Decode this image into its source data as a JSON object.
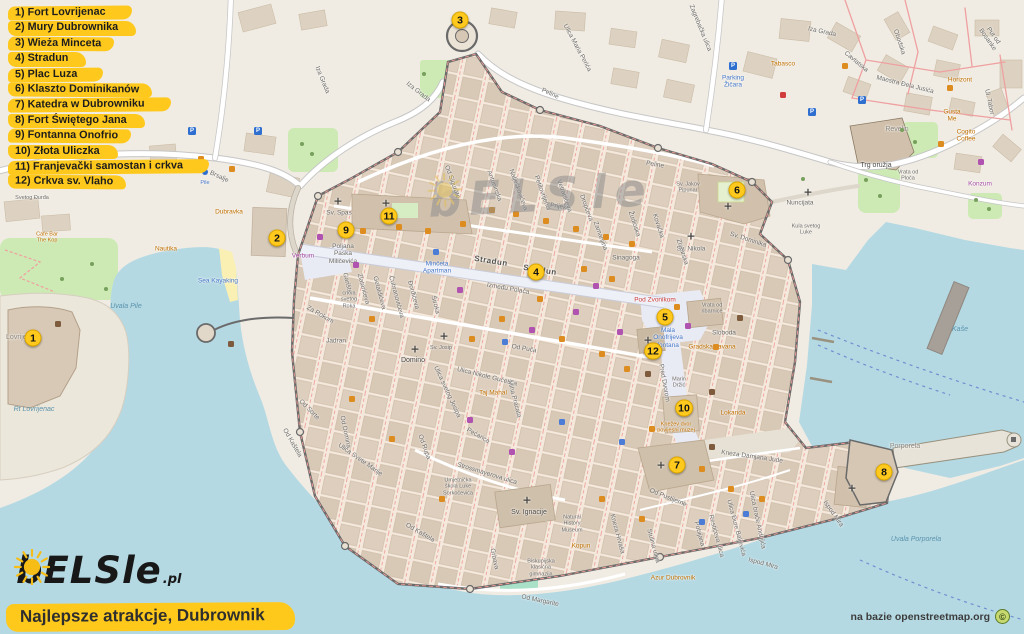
{
  "legend": {
    "items": [
      "1) Fort Lovrijenac",
      "2) Mury Dubrownika",
      "3) Wieża Minceta",
      "4) Stradun",
      "5) Plac Luza",
      "6) Klaszto Dominikanów",
      "7) Katedra w Dubrowniku",
      "8) Fort Świętego Jana",
      "9) Fontanna Onofrio",
      "10) Złota Uliczka",
      "11) Franjevački samostan i crkva",
      "12) Crkva sv. Vlaho"
    ]
  },
  "watermark": {
    "left": "bELS",
    "right": "le",
    "sun_icon": "sun-icon"
  },
  "logo": {
    "left": "bELS",
    "right": "le",
    "tld": ".pl",
    "sun_icon": "sun-icon"
  },
  "title": {
    "text": "Najlepsze atrakcje, Dubrownik"
  },
  "attribution": {
    "text": "na bazie openstreetmap.org",
    "symbol": "©"
  },
  "colors": {
    "legend_yellow": "#ffc81c",
    "marker_yellow": "#ffc91d",
    "water": "#b5d9e3",
    "land": "#f0ece3",
    "building": "#ddcebd",
    "wall": "#6a6a6a",
    "park": "#cdeab4"
  },
  "map": {
    "markers": [
      {
        "n": "1",
        "x": 33,
        "y": 338
      },
      {
        "n": "2",
        "x": 277,
        "y": 238
      },
      {
        "n": "3",
        "x": 460,
        "y": 20
      },
      {
        "n": "4",
        "x": 536,
        "y": 272
      },
      {
        "n": "5",
        "x": 665,
        "y": 317
      },
      {
        "n": "6",
        "x": 737,
        "y": 190
      },
      {
        "n": "7",
        "x": 677,
        "y": 465
      },
      {
        "n": "8",
        "x": 884,
        "y": 472
      },
      {
        "n": "9",
        "x": 346,
        "y": 230
      },
      {
        "n": "10",
        "x": 684,
        "y": 408
      },
      {
        "n": "11",
        "x": 389,
        "y": 216
      },
      {
        "n": "12",
        "x": 653,
        "y": 351
      }
    ],
    "labels": [
      {
        "t": "Zagrebačka ulica",
        "x": 700,
        "y": 28,
        "r": 68
      },
      {
        "t": "Iza Grada",
        "x": 822,
        "y": 32,
        "r": 12
      },
      {
        "t": "Iza Grada",
        "x": 418,
        "y": 92,
        "r": 38
      },
      {
        "t": "Iza Grada",
        "x": 322,
        "y": 80,
        "r": 68
      },
      {
        "t": "Ulica Maria Perića",
        "x": 577,
        "y": 48,
        "r": 62
      },
      {
        "t": "Parking\nŽičara",
        "x": 733,
        "y": 82,
        "c": "blu"
      },
      {
        "t": "Cavtatska",
        "x": 856,
        "y": 62,
        "r": 40
      },
      {
        "t": "Obodska",
        "x": 899,
        "y": 42,
        "r": 72
      },
      {
        "t": "Maestra Đela Jusića",
        "x": 905,
        "y": 85,
        "r": 14
      },
      {
        "t": "Put od Bosanke",
        "x": 990,
        "y": 38,
        "r": 55
      },
      {
        "t": "Ul. Tabor",
        "x": 989,
        "y": 102,
        "r": 78
      },
      {
        "t": "Horizont",
        "x": 960,
        "y": 80,
        "c": "poi"
      },
      {
        "t": "Gusta\nMe",
        "x": 952,
        "y": 116,
        "c": "poi"
      },
      {
        "t": "Cogito\nCoffee",
        "x": 966,
        "y": 136,
        "c": "poi"
      },
      {
        "t": "Tabasco",
        "x": 783,
        "y": 64,
        "c": "poi"
      },
      {
        "t": "Revelin",
        "x": 897,
        "y": 130,
        "c": "area"
      },
      {
        "t": "Trg oružja",
        "x": 876,
        "y": 166,
        "c": "dark"
      },
      {
        "t": "Vrata od\nPloča",
        "x": 908,
        "y": 176,
        "c": "sm"
      },
      {
        "t": "Kula svetog\nLuke",
        "x": 806,
        "y": 230,
        "c": "sm"
      },
      {
        "t": "Nuncijata",
        "x": 800,
        "y": 203
      },
      {
        "t": "Konzum",
        "x": 980,
        "y": 184,
        "c": "shop"
      },
      {
        "t": "Peline",
        "x": 550,
        "y": 94,
        "r": 25
      },
      {
        "t": "Peline",
        "x": 655,
        "y": 165,
        "r": 10
      },
      {
        "t": "Prijeko",
        "x": 560,
        "y": 207,
        "r": 9
      },
      {
        "t": "Stradun",
        "x": 491,
        "y": 261,
        "r": 9,
        "c": "lg"
      },
      {
        "t": "Stradun",
        "x": 540,
        "y": 270,
        "r": 9,
        "c": "lg"
      },
      {
        "t": "Između Polača",
        "x": 508,
        "y": 289,
        "r": 10
      },
      {
        "t": "Od Puča",
        "x": 524,
        "y": 349,
        "r": 10
      },
      {
        "t": "Od Sigurate",
        "x": 452,
        "y": 182,
        "r": 70
      },
      {
        "t": "Antuninska",
        "x": 494,
        "y": 186,
        "r": 70
      },
      {
        "t": "Nalješkovićeva",
        "x": 518,
        "y": 190,
        "r": 70
      },
      {
        "t": "Petilovrijenci",
        "x": 542,
        "y": 193,
        "r": 70
      },
      {
        "t": "Vetranićeva",
        "x": 564,
        "y": 196,
        "r": 70
      },
      {
        "t": "Dropčeva",
        "x": 586,
        "y": 208,
        "r": 70
      },
      {
        "t": "Zamanjina",
        "x": 600,
        "y": 236,
        "r": 70
      },
      {
        "t": "Žudioska",
        "x": 634,
        "y": 224,
        "r": 72
      },
      {
        "t": "Kovačka",
        "x": 658,
        "y": 226,
        "r": 72
      },
      {
        "t": "Zlatarska",
        "x": 682,
        "y": 252,
        "r": 72
      },
      {
        "t": "Sv. Jakov\nPipunar",
        "x": 688,
        "y": 188,
        "c": "sm"
      },
      {
        "t": "Sv. Nikola",
        "x": 691,
        "y": 249
      },
      {
        "t": "Sinagoga",
        "x": 626,
        "y": 258
      },
      {
        "t": "Sv. Dominika",
        "x": 748,
        "y": 240,
        "r": 18
      },
      {
        "t": "Sv. Spas",
        "x": 339,
        "y": 213
      },
      {
        "t": "Poljana\nPaska\nMiličevića",
        "x": 343,
        "y": 254
      },
      {
        "t": "Verbum",
        "x": 303,
        "y": 256,
        "c": "shop"
      },
      {
        "t": "Minčeta\nApartman",
        "x": 437,
        "y": 268,
        "c": "blu"
      },
      {
        "t": "Garište",
        "x": 347,
        "y": 283,
        "r": 75
      },
      {
        "t": "Zlatarićeva",
        "x": 363,
        "y": 289,
        "r": 75
      },
      {
        "t": "Getaldićeva",
        "x": 379,
        "y": 293,
        "r": 75
      },
      {
        "t": "Čubranovićeva",
        "x": 396,
        "y": 297,
        "r": 75
      },
      {
        "t": "Đorđićeva",
        "x": 413,
        "y": 295,
        "r": 75
      },
      {
        "t": "Široka",
        "x": 435,
        "y": 305,
        "r": 75
      },
      {
        "t": "crkva\nsvetog\nRoka",
        "x": 349,
        "y": 300,
        "c": "sm"
      },
      {
        "t": "Za Rokom",
        "x": 320,
        "y": 315,
        "r": 30
      },
      {
        "t": "Jadran",
        "x": 336,
        "y": 341
      },
      {
        "t": "Domino",
        "x": 413,
        "y": 361,
        "c": "dark"
      },
      {
        "t": "Sv. Josip",
        "x": 441,
        "y": 348,
        "c": "sm"
      },
      {
        "t": "Ulica svetog Josipa",
        "x": 447,
        "y": 392,
        "r": 65
      },
      {
        "t": "Od Domina",
        "x": 345,
        "y": 432,
        "r": 78
      },
      {
        "t": "Od Sorte",
        "x": 309,
        "y": 410,
        "r": 45
      },
      {
        "t": "Od Kaštela",
        "x": 292,
        "y": 443,
        "r": 60
      },
      {
        "t": "Od Kaštela",
        "x": 420,
        "y": 533,
        "r": 30
      },
      {
        "t": "Od Rupa",
        "x": 424,
        "y": 447,
        "r": 70
      },
      {
        "t": "Ulica Svete Marije",
        "x": 360,
        "y": 460,
        "r": 35
      },
      {
        "t": "Ulica Nikole Gučetića",
        "x": 487,
        "y": 377,
        "r": 14
      },
      {
        "t": "Miha Pracata",
        "x": 514,
        "y": 399,
        "r": 75
      },
      {
        "t": "Pećarica",
        "x": 478,
        "y": 436,
        "r": 30
      },
      {
        "t": "Taj Mahal",
        "x": 493,
        "y": 393,
        "c": "poi"
      },
      {
        "t": "Strossmayerova ulica",
        "x": 487,
        "y": 474,
        "r": 17
      },
      {
        "t": "Umjetnička\nškola Luke\nSorkočevića",
        "x": 458,
        "y": 487,
        "c": "sm"
      },
      {
        "t": "Sv. Ignacije",
        "x": 529,
        "y": 513,
        "c": "dark"
      },
      {
        "t": "Grbava",
        "x": 494,
        "y": 559,
        "r": 78
      },
      {
        "t": "Biskupijska\nklasična\ngimnazija",
        "x": 541,
        "y": 568,
        "c": "sm"
      },
      {
        "t": "Od Margarite",
        "x": 540,
        "y": 601,
        "r": 12
      },
      {
        "t": "Natural\nHistory\nMuseum",
        "x": 572,
        "y": 524,
        "c": "sm"
      },
      {
        "t": "Kopun",
        "x": 581,
        "y": 546,
        "c": "poi"
      },
      {
        "t": "Kneza Hrvaša",
        "x": 617,
        "y": 534,
        "r": 75
      },
      {
        "t": "Od Pustijerne",
        "x": 668,
        "y": 498,
        "r": 22
      },
      {
        "t": "Stulina ulica",
        "x": 653,
        "y": 546,
        "r": 75
      },
      {
        "t": "Pobijana",
        "x": 699,
        "y": 534,
        "r": 75
      },
      {
        "t": "Restićeva ulica",
        "x": 716,
        "y": 536,
        "r": 75
      },
      {
        "t": "Ulica Đure Baljevića",
        "x": 736,
        "y": 528,
        "r": 75
      },
      {
        "t": "Ulica braće Andrijića",
        "x": 757,
        "y": 520,
        "r": 78
      },
      {
        "t": "Ispod Mira",
        "x": 763,
        "y": 564,
        "r": 15
      },
      {
        "t": "Ispod Mira",
        "x": 833,
        "y": 514,
        "r": 55
      },
      {
        "t": "Azur Dubrovnik",
        "x": 673,
        "y": 578,
        "c": "poi"
      },
      {
        "t": "Kneza Damjana Jude",
        "x": 752,
        "y": 457,
        "r": 8
      },
      {
        "t": "Pred Dvorom",
        "x": 664,
        "y": 383,
        "r": 80
      },
      {
        "t": "Pod Zvonikom",
        "x": 655,
        "y": 300,
        "c": "red"
      },
      {
        "t": "Mala\nOnofrijeva\nfontana",
        "x": 668,
        "y": 338,
        "c": "blu"
      },
      {
        "t": "Vrata od\nribarnice",
        "x": 712,
        "y": 309,
        "c": "sm"
      },
      {
        "t": "Sloboda",
        "x": 724,
        "y": 333
      },
      {
        "t": "Gradska kavana",
        "x": 712,
        "y": 347,
        "c": "poi"
      },
      {
        "t": "Marin\nDržić",
        "x": 679,
        "y": 383,
        "c": "sm"
      },
      {
        "t": "Lokanda",
        "x": 733,
        "y": 413,
        "c": "poi"
      },
      {
        "t": "Knežev dvor\npovijesni muzej",
        "x": 676,
        "y": 428,
        "c": "poi sm"
      },
      {
        "t": "Porporela",
        "x": 905,
        "y": 447,
        "c": "area"
      },
      {
        "t": "Uvala Porporela",
        "x": 916,
        "y": 540,
        "c": "wtr"
      },
      {
        "t": "Kaše",
        "x": 960,
        "y": 330,
        "c": "wtr sm"
      },
      {
        "t": "Rt Lovrijenac",
        "x": 34,
        "y": 410,
        "c": "wtr sm"
      },
      {
        "t": "Lovrijenac",
        "x": 22,
        "y": 338,
        "c": "area"
      },
      {
        "t": "Uvala Pile",
        "x": 126,
        "y": 307,
        "c": "wtr"
      },
      {
        "t": "Sea Kayaking",
        "x": 218,
        "y": 281,
        "c": "blu"
      },
      {
        "t": "Nautika",
        "x": 166,
        "y": 249,
        "c": "poi"
      },
      {
        "t": "Dubravka",
        "x": 229,
        "y": 212,
        "c": "poi"
      },
      {
        "t": "Brsalje",
        "x": 219,
        "y": 177,
        "r": 25
      },
      {
        "t": "Pile",
        "x": 205,
        "y": 183,
        "c": "blu sm"
      },
      {
        "t": "Cafe Bar\nThe Kop",
        "x": 47,
        "y": 238,
        "c": "poi sm"
      },
      {
        "t": "Svetog Đurđa",
        "x": 32,
        "y": 198,
        "c": "sm"
      }
    ],
    "pois": [
      {
        "x": 338,
        "y": 201,
        "c": "x"
      },
      {
        "x": 386,
        "y": 203,
        "c": "x"
      },
      {
        "x": 415,
        "y": 349,
        "c": "x"
      },
      {
        "x": 444,
        "y": 336,
        "c": "x"
      },
      {
        "x": 527,
        "y": 500,
        "c": "x"
      },
      {
        "x": 691,
        "y": 236,
        "c": "x"
      },
      {
        "x": 728,
        "y": 206,
        "c": "x"
      },
      {
        "x": 661,
        "y": 465,
        "c": "x"
      },
      {
        "x": 852,
        "y": 488,
        "c": "x"
      },
      {
        "x": 648,
        "y": 340,
        "c": "x"
      },
      {
        "x": 808,
        "y": 192,
        "c": "x"
      },
      {
        "x": 733,
        "y": 66,
        "c": "p"
      },
      {
        "x": 812,
        "y": 112,
        "c": "p"
      },
      {
        "x": 862,
        "y": 100,
        "c": "p"
      },
      {
        "x": 192,
        "y": 131,
        "c": "p"
      },
      {
        "x": 258,
        "y": 131,
        "c": "p"
      },
      {
        "x": 205,
        "y": 172,
        "c": "b"
      },
      {
        "x": 783,
        "y": 95,
        "c": "a"
      },
      {
        "x": 436,
        "y": 252,
        "c": "h"
      },
      {
        "x": 505,
        "y": 342,
        "c": "h"
      },
      {
        "x": 562,
        "y": 422,
        "c": "h"
      },
      {
        "x": 622,
        "y": 442,
        "c": "h"
      },
      {
        "x": 702,
        "y": 522,
        "c": "h"
      },
      {
        "x": 746,
        "y": 514,
        "c": "h"
      },
      {
        "x": 320,
        "y": 237,
        "c": "s"
      },
      {
        "x": 356,
        "y": 265,
        "c": "s"
      },
      {
        "x": 460,
        "y": 290,
        "c": "s"
      },
      {
        "x": 532,
        "y": 330,
        "c": "s"
      },
      {
        "x": 576,
        "y": 312,
        "c": "s"
      },
      {
        "x": 620,
        "y": 332,
        "c": "s"
      },
      {
        "x": 688,
        "y": 326,
        "c": "s"
      },
      {
        "x": 470,
        "y": 420,
        "c": "s"
      },
      {
        "x": 512,
        "y": 452,
        "c": "s"
      },
      {
        "x": 981,
        "y": 162,
        "c": "s"
      },
      {
        "x": 596,
        "y": 286,
        "c": "s"
      },
      {
        "x": 58,
        "y": 324,
        "c": "m"
      },
      {
        "x": 740,
        "y": 318,
        "c": "m"
      },
      {
        "x": 712,
        "y": 392,
        "c": "m"
      },
      {
        "x": 231,
        "y": 344,
        "c": "m"
      },
      {
        "x": 648,
        "y": 374,
        "c": "m"
      },
      {
        "x": 712,
        "y": 447,
        "c": "m"
      },
      {
        "x": 363,
        "y": 231,
        "c": "f"
      },
      {
        "x": 399,
        "y": 227,
        "c": "f"
      },
      {
        "x": 428,
        "y": 231,
        "c": "f"
      },
      {
        "x": 463,
        "y": 224,
        "c": "f"
      },
      {
        "x": 492,
        "y": 210,
        "c": "f"
      },
      {
        "x": 516,
        "y": 214,
        "c": "f"
      },
      {
        "x": 546,
        "y": 221,
        "c": "f"
      },
      {
        "x": 576,
        "y": 229,
        "c": "f"
      },
      {
        "x": 606,
        "y": 237,
        "c": "f"
      },
      {
        "x": 632,
        "y": 244,
        "c": "f"
      },
      {
        "x": 584,
        "y": 269,
        "c": "f"
      },
      {
        "x": 612,
        "y": 279,
        "c": "f"
      },
      {
        "x": 540,
        "y": 299,
        "c": "f"
      },
      {
        "x": 502,
        "y": 319,
        "c": "f"
      },
      {
        "x": 472,
        "y": 339,
        "c": "f"
      },
      {
        "x": 562,
        "y": 339,
        "c": "f"
      },
      {
        "x": 602,
        "y": 354,
        "c": "f"
      },
      {
        "x": 627,
        "y": 369,
        "c": "f"
      },
      {
        "x": 652,
        "y": 429,
        "c": "f"
      },
      {
        "x": 702,
        "y": 469,
        "c": "f"
      },
      {
        "x": 731,
        "y": 489,
        "c": "f"
      },
      {
        "x": 762,
        "y": 499,
        "c": "f"
      },
      {
        "x": 372,
        "y": 319,
        "c": "f"
      },
      {
        "x": 352,
        "y": 399,
        "c": "f"
      },
      {
        "x": 392,
        "y": 439,
        "c": "f"
      },
      {
        "x": 442,
        "y": 499,
        "c": "f"
      },
      {
        "x": 602,
        "y": 499,
        "c": "f"
      },
      {
        "x": 642,
        "y": 519,
        "c": "f"
      },
      {
        "x": 201,
        "y": 159,
        "c": "f"
      },
      {
        "x": 232,
        "y": 169,
        "c": "f"
      },
      {
        "x": 950,
        "y": 88,
        "c": "f"
      },
      {
        "x": 941,
        "y": 144,
        "c": "f"
      },
      {
        "x": 845,
        "y": 66,
        "c": "f"
      },
      {
        "x": 716,
        "y": 347,
        "c": "f"
      },
      {
        "x": 677,
        "y": 307,
        "c": "f"
      },
      {
        "x": 902,
        "y": 130,
        "c": "t"
      },
      {
        "x": 915,
        "y": 142,
        "c": "t"
      },
      {
        "x": 976,
        "y": 200,
        "c": "t"
      },
      {
        "x": 989,
        "y": 209,
        "c": "t"
      },
      {
        "x": 424,
        "y": 74,
        "c": "t"
      },
      {
        "x": 302,
        "y": 144,
        "c": "t"
      },
      {
        "x": 312,
        "y": 154,
        "c": "t"
      },
      {
        "x": 737,
        "y": 184,
        "c": "t"
      },
      {
        "x": 803,
        "y": 179,
        "c": "t"
      },
      {
        "x": 92,
        "y": 264,
        "c": "t"
      },
      {
        "x": 62,
        "y": 279,
        "c": "t"
      },
      {
        "x": 106,
        "y": 289,
        "c": "t"
      },
      {
        "x": 866,
        "y": 180,
        "c": "t"
      },
      {
        "x": 880,
        "y": 196,
        "c": "t"
      }
    ]
  }
}
